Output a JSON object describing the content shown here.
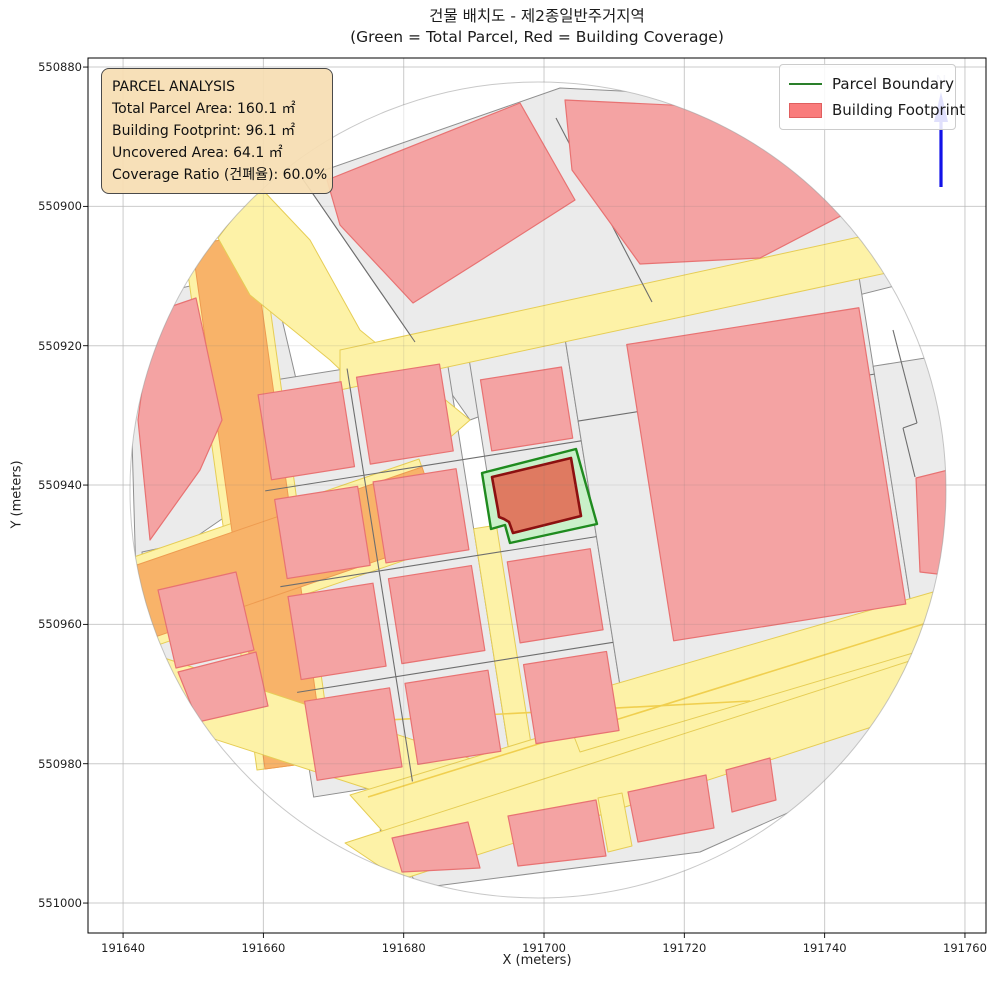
{
  "title": {
    "line1": "건물 배치도 - 제2종일반주거지역",
    "line2": "(Green = Total Parcel, Red = Building Coverage)"
  },
  "axes": {
    "xlabel": "X (meters)",
    "ylabel": "Y (meters)",
    "x_ticks": [
      "191640",
      "191660",
      "191680",
      "191700",
      "191720",
      "191740",
      "191760"
    ],
    "y_ticks": [
      "551000",
      "550980",
      "550960",
      "550940",
      "550920",
      "550900",
      "550880"
    ]
  },
  "annotation": {
    "title": "PARCEL ANALYSIS",
    "lines": [
      "Total Parcel Area: 160.1 ㎡",
      "Building Footprint: 96.1 ㎡",
      "Uncovered Area: 64.1 ㎡",
      "Coverage Ratio (건폐율): 60.0%"
    ]
  },
  "legend": {
    "items": [
      {
        "label": "Parcel Boundary",
        "type": "line",
        "color": "#2a7f2a"
      },
      {
        "label": "Building Footprint",
        "type": "patch",
        "color": "#f97c7c",
        "edge": "#e05f5f"
      }
    ]
  },
  "north_arrow": {
    "label": "N",
    "color": "#1313e8"
  },
  "chart_data": {
    "type": "map",
    "title": "건물 배치도 - 제2종일반주거지역",
    "subtitle": "(Green = Total Parcel, Red = Building Coverage)",
    "xlabel": "X (meters)",
    "ylabel": "Y (meters)",
    "xlim": [
      191635.0,
      191763.0
    ],
    "ylim": [
      550875.7,
      551001.3
    ],
    "x_ticks": [
      191640,
      191660,
      191680,
      191700,
      191720,
      191740,
      191760
    ],
    "y_ticks": [
      550880,
      550900,
      550920,
      550940,
      550960,
      550980,
      551000
    ],
    "grid": true,
    "legend_position": "upper right",
    "zoning": "제2종일반주거지역",
    "parcel_analysis": {
      "total_parcel_area_m2": 160.1,
      "building_footprint_m2": 96.1,
      "uncovered_area_m2": 64.1,
      "coverage_ratio_pct": 60.0
    },
    "highlighted_parcel": {
      "approx_center": {
        "x": 191697,
        "y": 550939
      },
      "boundary_color": "#1f8b1f",
      "parcel_fill": "#c9f0c9",
      "building_fill": "#df7a61",
      "building_edge": "#8c1010"
    },
    "clip_circle": {
      "center_x": 191699,
      "center_y": 550939.4,
      "radius_m": 58.3
    }
  },
  "map_px": {
    "plot_rect": [
      88,
      58,
      898,
      875
    ],
    "clip": {
      "cx": 538,
      "cy": 490,
      "r": 408
    },
    "grid_rotation": [
      -9,
      540,
      500
    ],
    "styles": {
      "gray": {
        "fill": "#ebebeb",
        "stroke": "#8f8f8f",
        "sw": 1
      },
      "grayd": {
        "fill": "none",
        "stroke": "#6e6e6e",
        "sw": 1.1
      },
      "orange": {
        "fill": "#f8b369",
        "stroke": "#ee9b50",
        "sw": 1
      },
      "yellow": {
        "fill": "#fdf2a7",
        "stroke": "#e6cd55",
        "sw": 1
      },
      "yline": {
        "fill": "none",
        "stroke": "#f0cf4f",
        "sw": 1.6
      },
      "pink": {
        "fill": "#f4a3a3",
        "stroke": "#e87272",
        "sw": 1.2
      },
      "green": {
        "fill": "#c9f0c9",
        "stroke": "#1f8b1f",
        "sw": 2.4
      },
      "red": {
        "fill": "#df7a61",
        "stroke": "#8c1010",
        "sw": 2.6
      }
    },
    "names": {
      "gray": "map-parcel",
      "grayd": "map-parcel-line",
      "orange": "map-road",
      "yellow": "map-road",
      "yline": "map-road-line",
      "pink": "map-building",
      "green": "parcel-boundary-highlight",
      "red": "building-footprint-highlight"
    },
    "features": [
      {
        "c": "gray",
        "p": [
          [
            302,
            178
          ],
          [
            560,
            88
          ],
          [
            905,
            105
          ],
          [
            938,
            275
          ],
          [
            700,
            335
          ],
          [
            470,
            420
          ],
          [
            415,
            342
          ]
        ]
      },
      {
        "c": "gray",
        "p": [
          [
            128,
            300
          ],
          [
            270,
            268
          ],
          [
            308,
            430
          ],
          [
            238,
            508
          ],
          [
            136,
            578
          ]
        ]
      },
      {
        "c": "gray",
        "p": [
          [
            142,
            552
          ],
          [
            292,
            520
          ],
          [
            322,
            700
          ],
          [
            205,
            735
          ],
          [
            148,
            640
          ]
        ]
      },
      {
        "c": "gray",
        "p": [
          [
            380,
            830
          ],
          [
            740,
            745
          ],
          [
            860,
            700
          ],
          [
            902,
            762
          ],
          [
            700,
            852
          ],
          [
            420,
            888
          ]
        ]
      },
      {
        "c": "gray",
        "r": [
          270,
          340,
          200,
          418
        ],
        "rot": true
      },
      {
        "c": "gray",
        "r": [
          492,
          340,
          98,
          418
        ],
        "rot": true
      },
      {
        "c": "gray",
        "r": [
          590,
          315,
          300,
          385
        ],
        "rot": true
      },
      {
        "c": "gray",
        "r": [
          890,
          420,
          62,
          280
        ],
        "rot": true
      },
      {
        "c": "yellow",
        "p": [
          [
            184,
            245
          ],
          [
            260,
            235
          ],
          [
            333,
            760
          ],
          [
            257,
            770
          ]
        ]
      },
      {
        "c": "yellow",
        "p": [
          [
            123,
            657
          ],
          [
            93,
            571
          ],
          [
            419,
            459
          ],
          [
            449,
            545
          ]
        ]
      },
      {
        "c": "orange",
        "p": [
          [
            192,
            244
          ],
          [
            252,
            236
          ],
          [
            325,
            761
          ],
          [
            265,
            769
          ]
        ]
      },
      {
        "c": "orange",
        "p": [
          [
            120,
            649
          ],
          [
            96,
            579
          ],
          [
            422,
            467
          ],
          [
            446,
            537
          ]
        ]
      },
      {
        "c": "yellow",
        "p": [
          [
            258,
            185
          ],
          [
            310,
            240
          ],
          [
            360,
            330
          ],
          [
            470,
            420
          ],
          [
            430,
            455
          ],
          [
            330,
            360
          ],
          [
            250,
            295
          ],
          [
            218,
            238
          ]
        ]
      },
      {
        "c": "yellow",
        "p": [
          [
            340,
            350
          ],
          [
            900,
            228
          ],
          [
            910,
            268
          ],
          [
            340,
            390
          ]
        ]
      },
      {
        "c": "yellow",
        "r": [
          470,
          518,
          23,
          252
        ],
        "rot": true
      },
      {
        "c": "yellow",
        "p": [
          [
            140,
            650
          ],
          [
            520,
            775
          ],
          [
            520,
            838
          ],
          [
            140,
            715
          ]
        ]
      },
      {
        "c": "yellow",
        "p": [
          [
            350,
            795
          ],
          [
            950,
            612
          ],
          [
            950,
            672
          ],
          [
            395,
            845
          ]
        ]
      },
      {
        "c": "yellow",
        "p": [
          [
            560,
            700
          ],
          [
            940,
            590
          ],
          [
            950,
            642
          ],
          [
            580,
            752
          ]
        ]
      },
      {
        "c": "yellow",
        "p": [
          [
            345,
            843
          ],
          [
            950,
            648
          ],
          [
            955,
            700
          ],
          [
            400,
            880
          ]
        ]
      },
      {
        "c": "yellow",
        "p": [
          [
            598,
            798
          ],
          [
            622,
            793
          ],
          [
            632,
            846
          ],
          [
            608,
            852
          ]
        ]
      },
      {
        "c": "yline",
        "l": [
          [
            368,
            797
          ],
          [
            930,
            622
          ]
        ]
      },
      {
        "c": "yline",
        "l": [
          [
            330,
            723
          ],
          [
            750,
            701
          ]
        ]
      },
      {
        "c": "grayd",
        "l": [
          [
            370,
            340
          ],
          [
            370,
            758
          ]
        ],
        "rot": true
      },
      {
        "c": "grayd",
        "l": [
          [
            270,
            448
          ],
          [
            590,
            448
          ]
        ],
        "rot": true
      },
      {
        "c": "grayd",
        "l": [
          [
            270,
            545
          ],
          [
            590,
            545
          ]
        ],
        "rot": true
      },
      {
        "c": "grayd",
        "l": [
          [
            270,
            652
          ],
          [
            590,
            652
          ]
        ],
        "rot": true
      },
      {
        "c": "grayd",
        "l": [
          [
            590,
            428
          ],
          [
            890,
            428
          ]
        ],
        "rot": true
      },
      {
        "c": "grayd",
        "l": [
          [
            302,
            178
          ],
          [
            415,
            342
          ]
        ]
      },
      {
        "c": "grayd",
        "l": [
          [
            556,
            118
          ],
          [
            652,
            302
          ]
        ]
      },
      {
        "c": "grayd",
        "l": [
          [
            893,
            330
          ],
          [
            917,
            423
          ]
        ]
      },
      {
        "c": "grayd",
        "l": [
          [
            917,
            423
          ],
          [
            903,
            428
          ]
        ]
      },
      {
        "c": "grayd",
        "l": [
          [
            903,
            428
          ],
          [
            915,
            477
          ]
        ]
      },
      {
        "c": "pink",
        "p": [
          [
            327,
            180
          ],
          [
            520,
            103
          ],
          [
            575,
            200
          ],
          [
            478,
            262
          ],
          [
            413,
            303
          ],
          [
            340,
            225
          ]
        ]
      },
      {
        "c": "pink",
        "p": [
          [
            565,
            100
          ],
          [
            880,
            115
          ],
          [
            906,
            182
          ],
          [
            760,
            258
          ],
          [
            640,
            264
          ],
          [
            572,
            170
          ]
        ]
      },
      {
        "c": "pink",
        "p": [
          [
            138,
            420
          ],
          [
            152,
            313
          ],
          [
            196,
            298
          ],
          [
            222,
            420
          ],
          [
            200,
            470
          ],
          [
            150,
            540
          ]
        ]
      },
      {
        "c": "pink",
        "p": [
          [
            158,
            590
          ],
          [
            236,
            572
          ],
          [
            254,
            650
          ],
          [
            176,
            668
          ]
        ]
      },
      {
        "c": "pink",
        "p": [
          [
            178,
            672
          ],
          [
            256,
            652
          ],
          [
            268,
            706
          ],
          [
            198,
            722
          ]
        ]
      },
      {
        "c": "pink",
        "r": [
          278,
          352,
          84,
          86
        ],
        "rot": true
      },
      {
        "c": "pink",
        "r": [
          378,
          350,
          84,
          88
        ],
        "rot": true
      },
      {
        "c": "pink",
        "r": [
          500,
          372,
          82,
          72
        ],
        "rot": true
      },
      {
        "c": "pink",
        "r": [
          278,
          458,
          84,
          80
        ],
        "rot": true
      },
      {
        "c": "pink",
        "r": [
          378,
          456,
          84,
          82
        ],
        "rot": true
      },
      {
        "c": "pink",
        "r": [
          276,
          556,
          86,
          84
        ],
        "rot": true
      },
      {
        "c": "pink",
        "r": [
          378,
          554,
          84,
          86
        ],
        "rot": true
      },
      {
        "c": "pink",
        "r": [
          498,
          556,
          84,
          82
        ],
        "rot": true
      },
      {
        "c": "pink",
        "r": [
          276,
          662,
          86,
          80
        ],
        "rot": true
      },
      {
        "c": "pink",
        "r": [
          378,
          660,
          84,
          82
        ],
        "rot": true
      },
      {
        "c": "pink",
        "r": [
          498,
          660,
          84,
          80
        ],
        "rot": true
      },
      {
        "c": "pink",
        "r": [
          650,
          360,
          235,
          300
        ],
        "rot": true
      },
      {
        "c": "pink",
        "p": [
          [
            916,
            478
          ],
          [
            948,
            470
          ],
          [
            946,
            575
          ],
          [
            920,
            572
          ]
        ]
      },
      {
        "c": "pink",
        "p": [
          [
            392,
            838
          ],
          [
            468,
            822
          ],
          [
            480,
            868
          ],
          [
            402,
            872
          ]
        ]
      },
      {
        "c": "pink",
        "p": [
          [
            508,
            816
          ],
          [
            596,
            800
          ],
          [
            606,
            856
          ],
          [
            518,
            866
          ]
        ]
      },
      {
        "c": "pink",
        "p": [
          [
            628,
            792
          ],
          [
            706,
            775
          ],
          [
            714,
            828
          ],
          [
            638,
            842
          ]
        ]
      },
      {
        "c": "pink",
        "p": [
          [
            726,
            770
          ],
          [
            770,
            758
          ],
          [
            776,
            800
          ],
          [
            732,
            812
          ]
        ]
      },
      {
        "c": "green",
        "p": [
          [
            482,
            473
          ],
          [
            576,
            449
          ],
          [
            597,
            524
          ],
          [
            510,
            543
          ],
          [
            505,
            525
          ],
          [
            491,
            529
          ]
        ]
      },
      {
        "c": "red",
        "p": [
          [
            492,
            477
          ],
          [
            571,
            458
          ],
          [
            581,
            516
          ],
          [
            513,
            533
          ],
          [
            509,
            522
          ],
          [
            504,
            519
          ],
          [
            499,
            517
          ],
          [
            498,
            510
          ]
        ]
      }
    ]
  }
}
